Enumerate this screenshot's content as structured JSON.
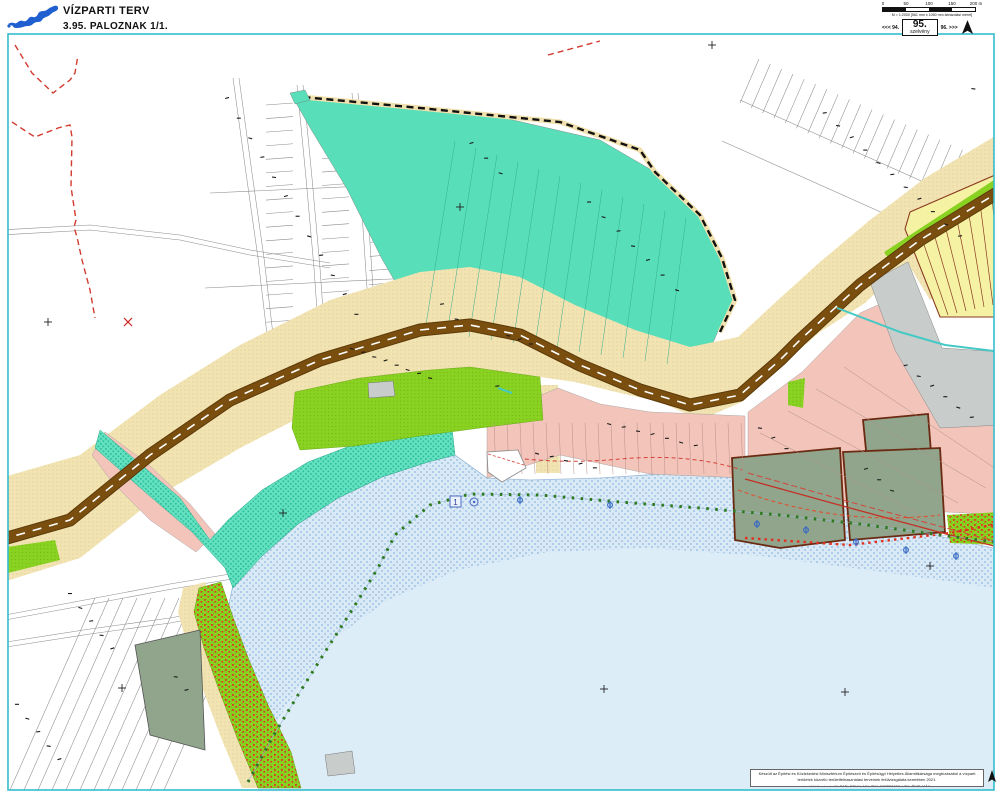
{
  "header": {
    "title": "VÍZPARTI TERV",
    "sheet_title": "3.95. PALOZNAK  1/1."
  },
  "scalebar": {
    "tick_labels": [
      "0",
      "50",
      "100",
      "150",
      "200 m"
    ],
    "scale_note": "M = 1:2000 [561 mm x 1050 mm ábrázolási méret]",
    "prev_sheet": "<<< 94.",
    "sheet_number": "95.",
    "sheet_word": "szelvény",
    "next_sheet": "96. >>>"
  },
  "map": {
    "water_marker_label": "1"
  },
  "footer": {
    "attribution_line1": "Készült az Építési és Közlekedési Minisztérium Építészeti és Építésügyi Helyettes Államtitkársága megbízásából a vízparti területek közcélú területfelhasználási terveinek felülvizsgálata keretében 2021.",
    "attribution_line2": "további források: MePAR, BFKH, MK, TIM, EOTR2020, LTK, ÉMT, MÁK"
  },
  "colors": {
    "frame_cyan": "#35BCCF",
    "road_brown": "#7A4E0F",
    "road_casing": "#5C3A08",
    "tan": "#F2E3B2",
    "tan_dot": "#D8BF85",
    "teal_solid": "#58DFB9",
    "teal_hatch": "#63E1C0",
    "lime": "#8AD222",
    "pink": "#F3C4BA",
    "sage": "#90A58C",
    "yellow": "#F5F2A3",
    "gray": "#C8CCCB",
    "water": "#DCEDF8",
    "water_pattern_dot": "#AECDE8",
    "boundary_red": "#D23B2F",
    "shore_green": "#2F7A1F",
    "stream_cyan": "#45C9C4",
    "maroon": "#6B2A12",
    "balaton_blue": "#1F5FD0"
  }
}
